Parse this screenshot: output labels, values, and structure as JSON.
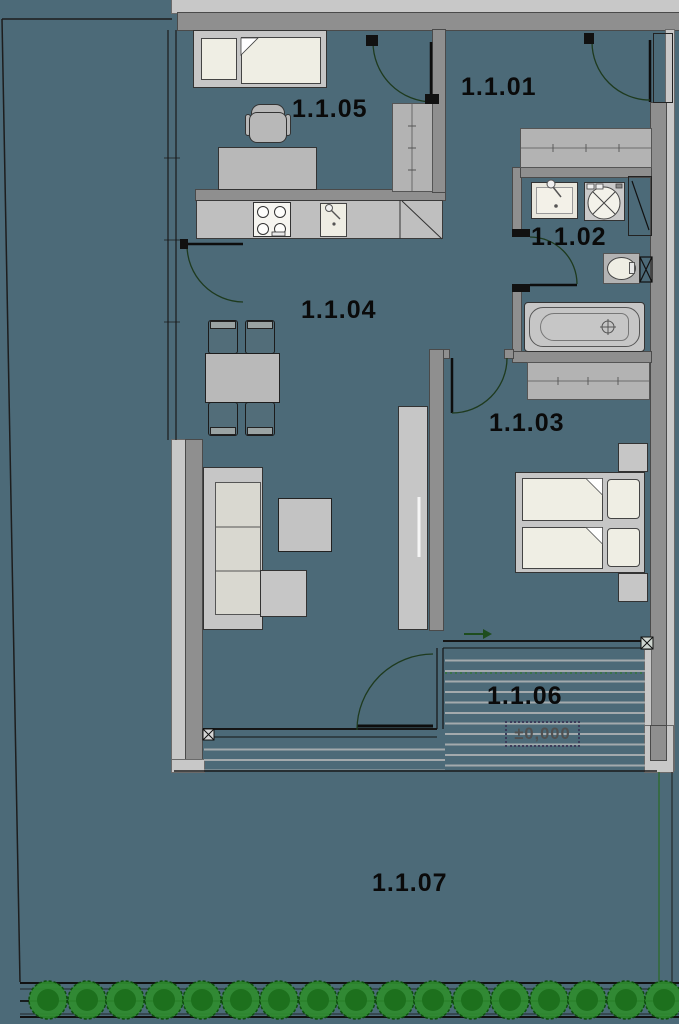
{
  "plan": {
    "room_labels": {
      "r01": "1.1.01",
      "r02": "1.1.02",
      "r03": "1.1.03",
      "r04": "1.1.04",
      "r05": "1.1.05",
      "r06": "1.1.06",
      "r07": "1.1.07"
    },
    "elevation_marker": "±0,000",
    "legend": {
      "floor_color": "#4c6a78",
      "wall_dark": "#8f8f8f",
      "wall_light": "#c8c8c8",
      "furniture_gray": "#c6c6c6",
      "furniture_cream": "#efeee4",
      "hedge_green": "#2f8c2f"
    }
  }
}
